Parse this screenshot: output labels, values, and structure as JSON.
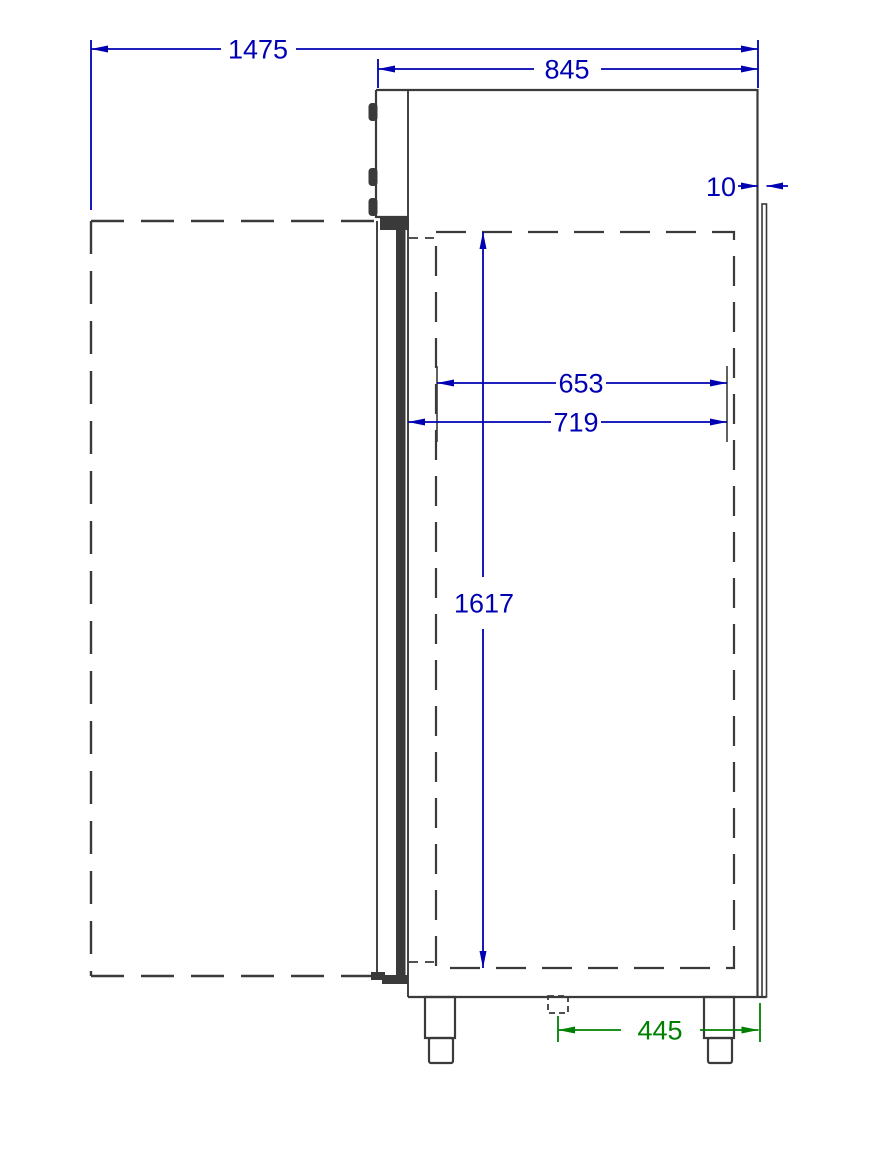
{
  "page": {
    "background": "#ffffff"
  },
  "drawing": {
    "kind": "cad-dimension-drawing",
    "subject": "upright-cabinet-side-view-door-open",
    "colors": {
      "line": "#3a3a3a",
      "dimension_primary": "#0000b3",
      "dimension_secondary": "#008000"
    },
    "dimensions": [
      {
        "value": "1475",
        "axis": "horizontal",
        "color_role": "primary"
      },
      {
        "value": "845",
        "axis": "horizontal",
        "color_role": "primary"
      },
      {
        "value": "10",
        "axis": "horizontal",
        "color_role": "primary"
      },
      {
        "value": "653",
        "axis": "horizontal",
        "color_role": "primary"
      },
      {
        "value": "719",
        "axis": "horizontal",
        "color_role": "primary"
      },
      {
        "value": "1617",
        "axis": "vertical",
        "color_role": "primary"
      },
      {
        "value": "445",
        "axis": "horizontal",
        "color_role": "secondary"
      }
    ]
  }
}
